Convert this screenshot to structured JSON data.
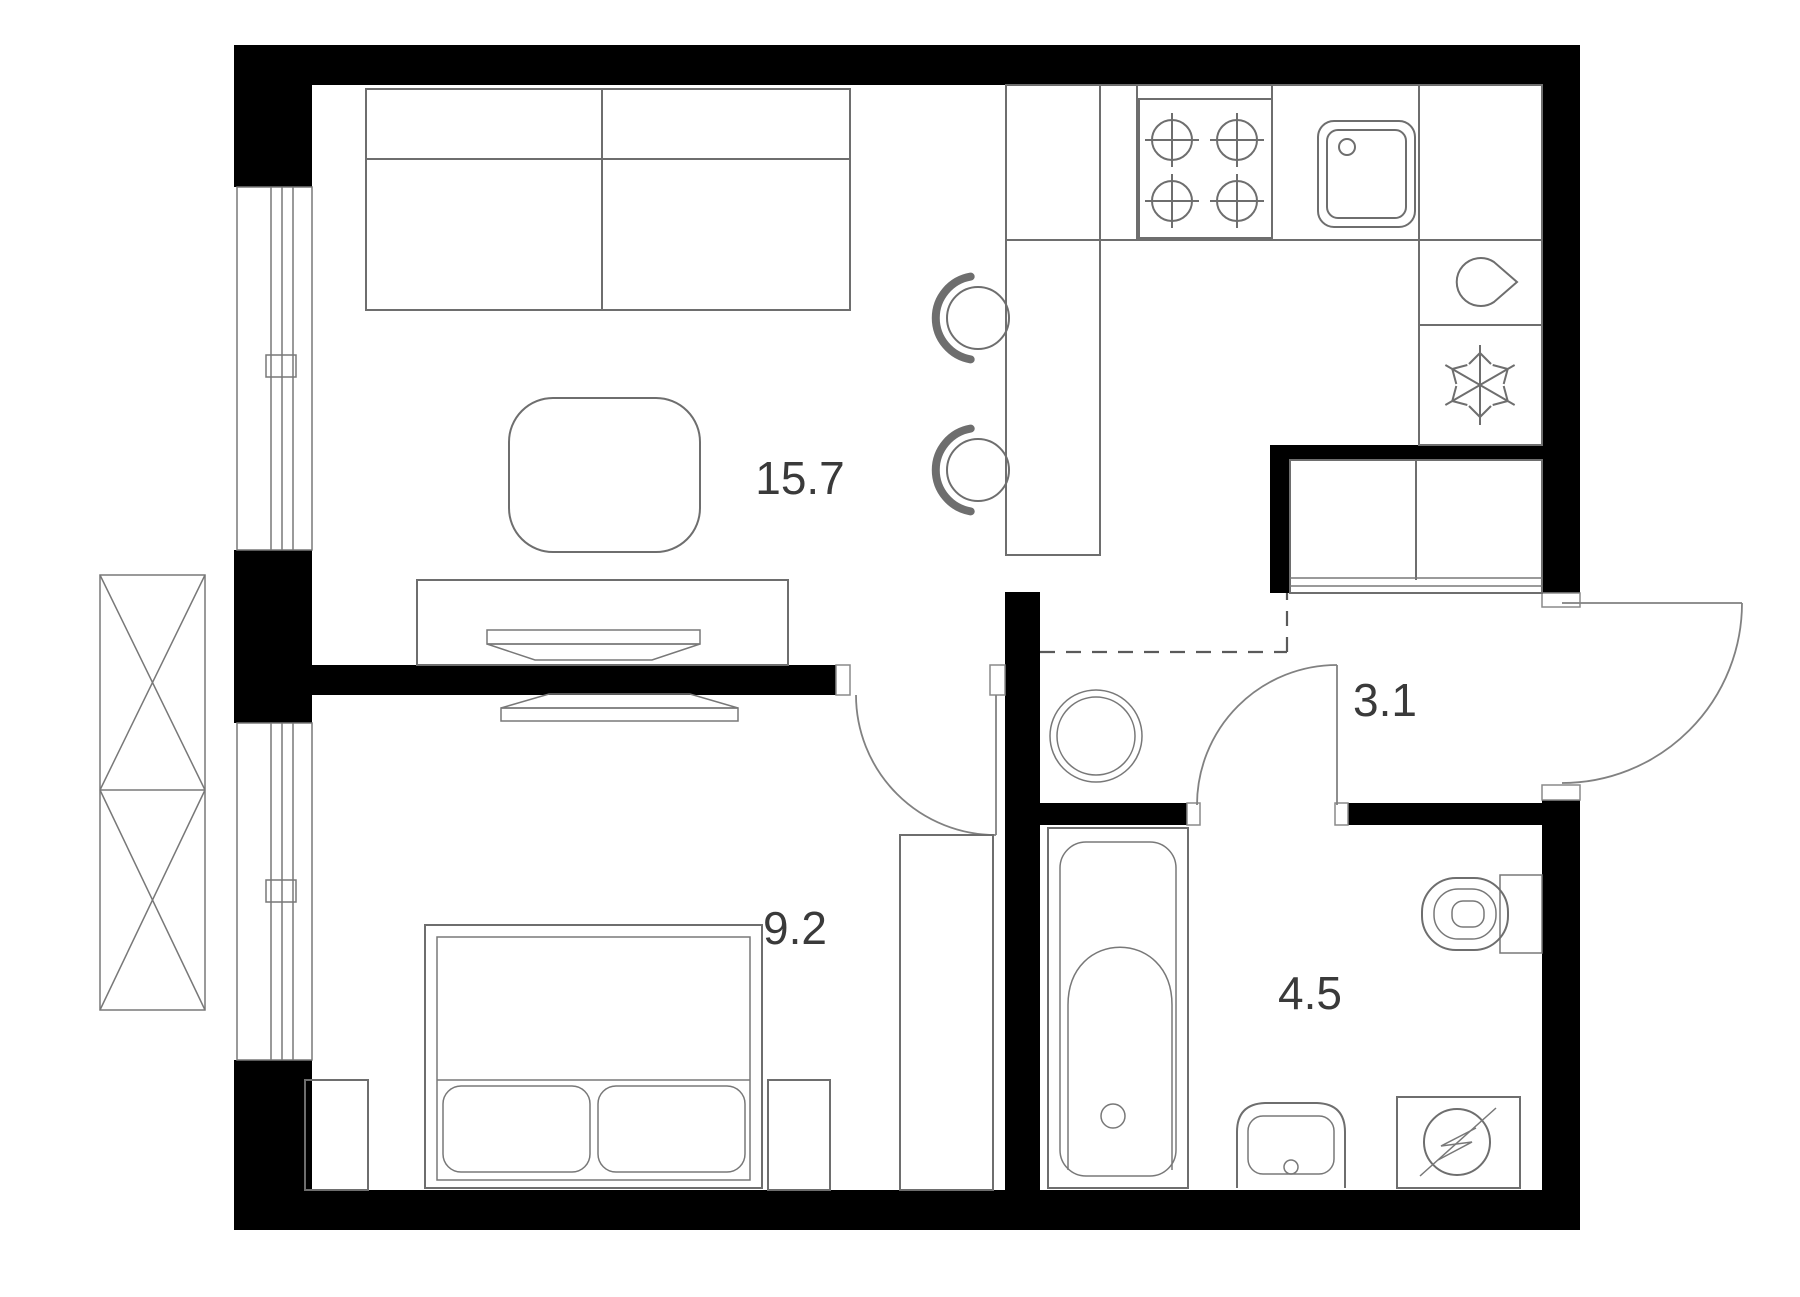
{
  "title": "Apartment floor plan",
  "floor_plan": {
    "rooms": [
      {
        "name": "living-kitchen",
        "area": "15.7"
      },
      {
        "name": "bedroom",
        "area": "9.2"
      },
      {
        "name": "hallway",
        "area": "3.1"
      },
      {
        "name": "bathroom",
        "area": "4.5"
      }
    ],
    "colors": {
      "wall": "#000000",
      "furniture_line": "#6e6e6e",
      "label_text": "#3a3a3a",
      "background": "#ffffff"
    },
    "icons": [
      "stove-burners-icon",
      "kitchen-sink-icon",
      "water-drop-icon",
      "snowflake-fridge-icon",
      "water-heater-icon",
      "bathtub-icon",
      "washbasin-icon",
      "washing-machine-icon",
      "toilet-icon",
      "window-icon",
      "ac-basket-icon"
    ]
  }
}
